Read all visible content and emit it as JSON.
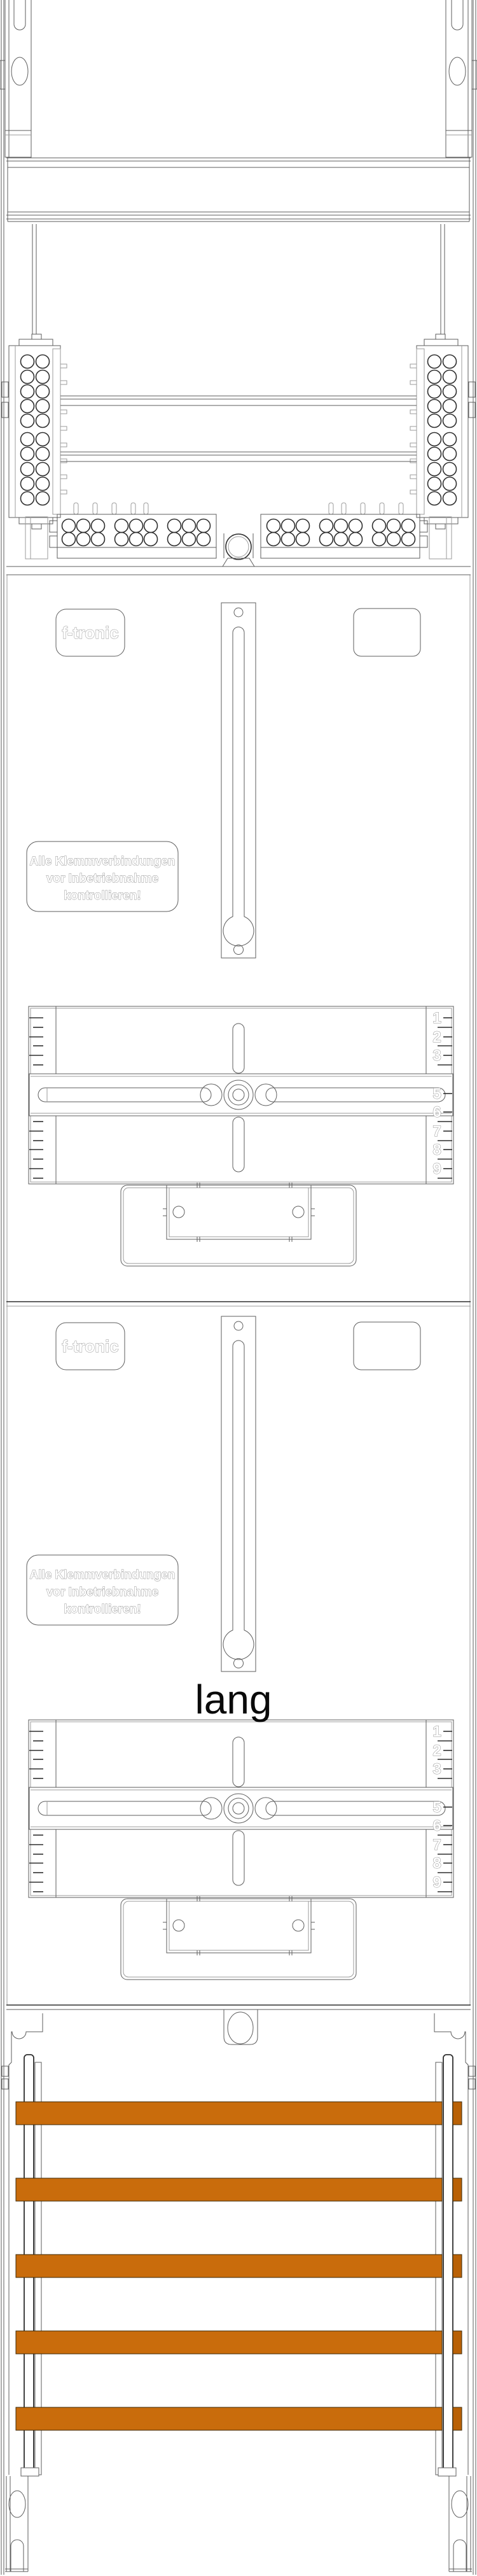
{
  "branding": {
    "logo_text": "f-tronic"
  },
  "warning_label": {
    "line1": "Alle Klemmverbindungen",
    "line2": "vor Inbetriebnahme",
    "line3": "kontrollieren!"
  },
  "annotation": {
    "length_label": "lang"
  },
  "ruler": {
    "digits": [
      "1",
      "2",
      "3",
      "5",
      "6",
      "7",
      "8",
      "9"
    ]
  },
  "colors": {
    "busbar_fill": "#C96C0C",
    "busbar_cap_fill": "#B96106",
    "outline_dark": "#2e2e2e",
    "outline_gray": "#5e5e5e",
    "outline_light": "#9b9b9b"
  }
}
